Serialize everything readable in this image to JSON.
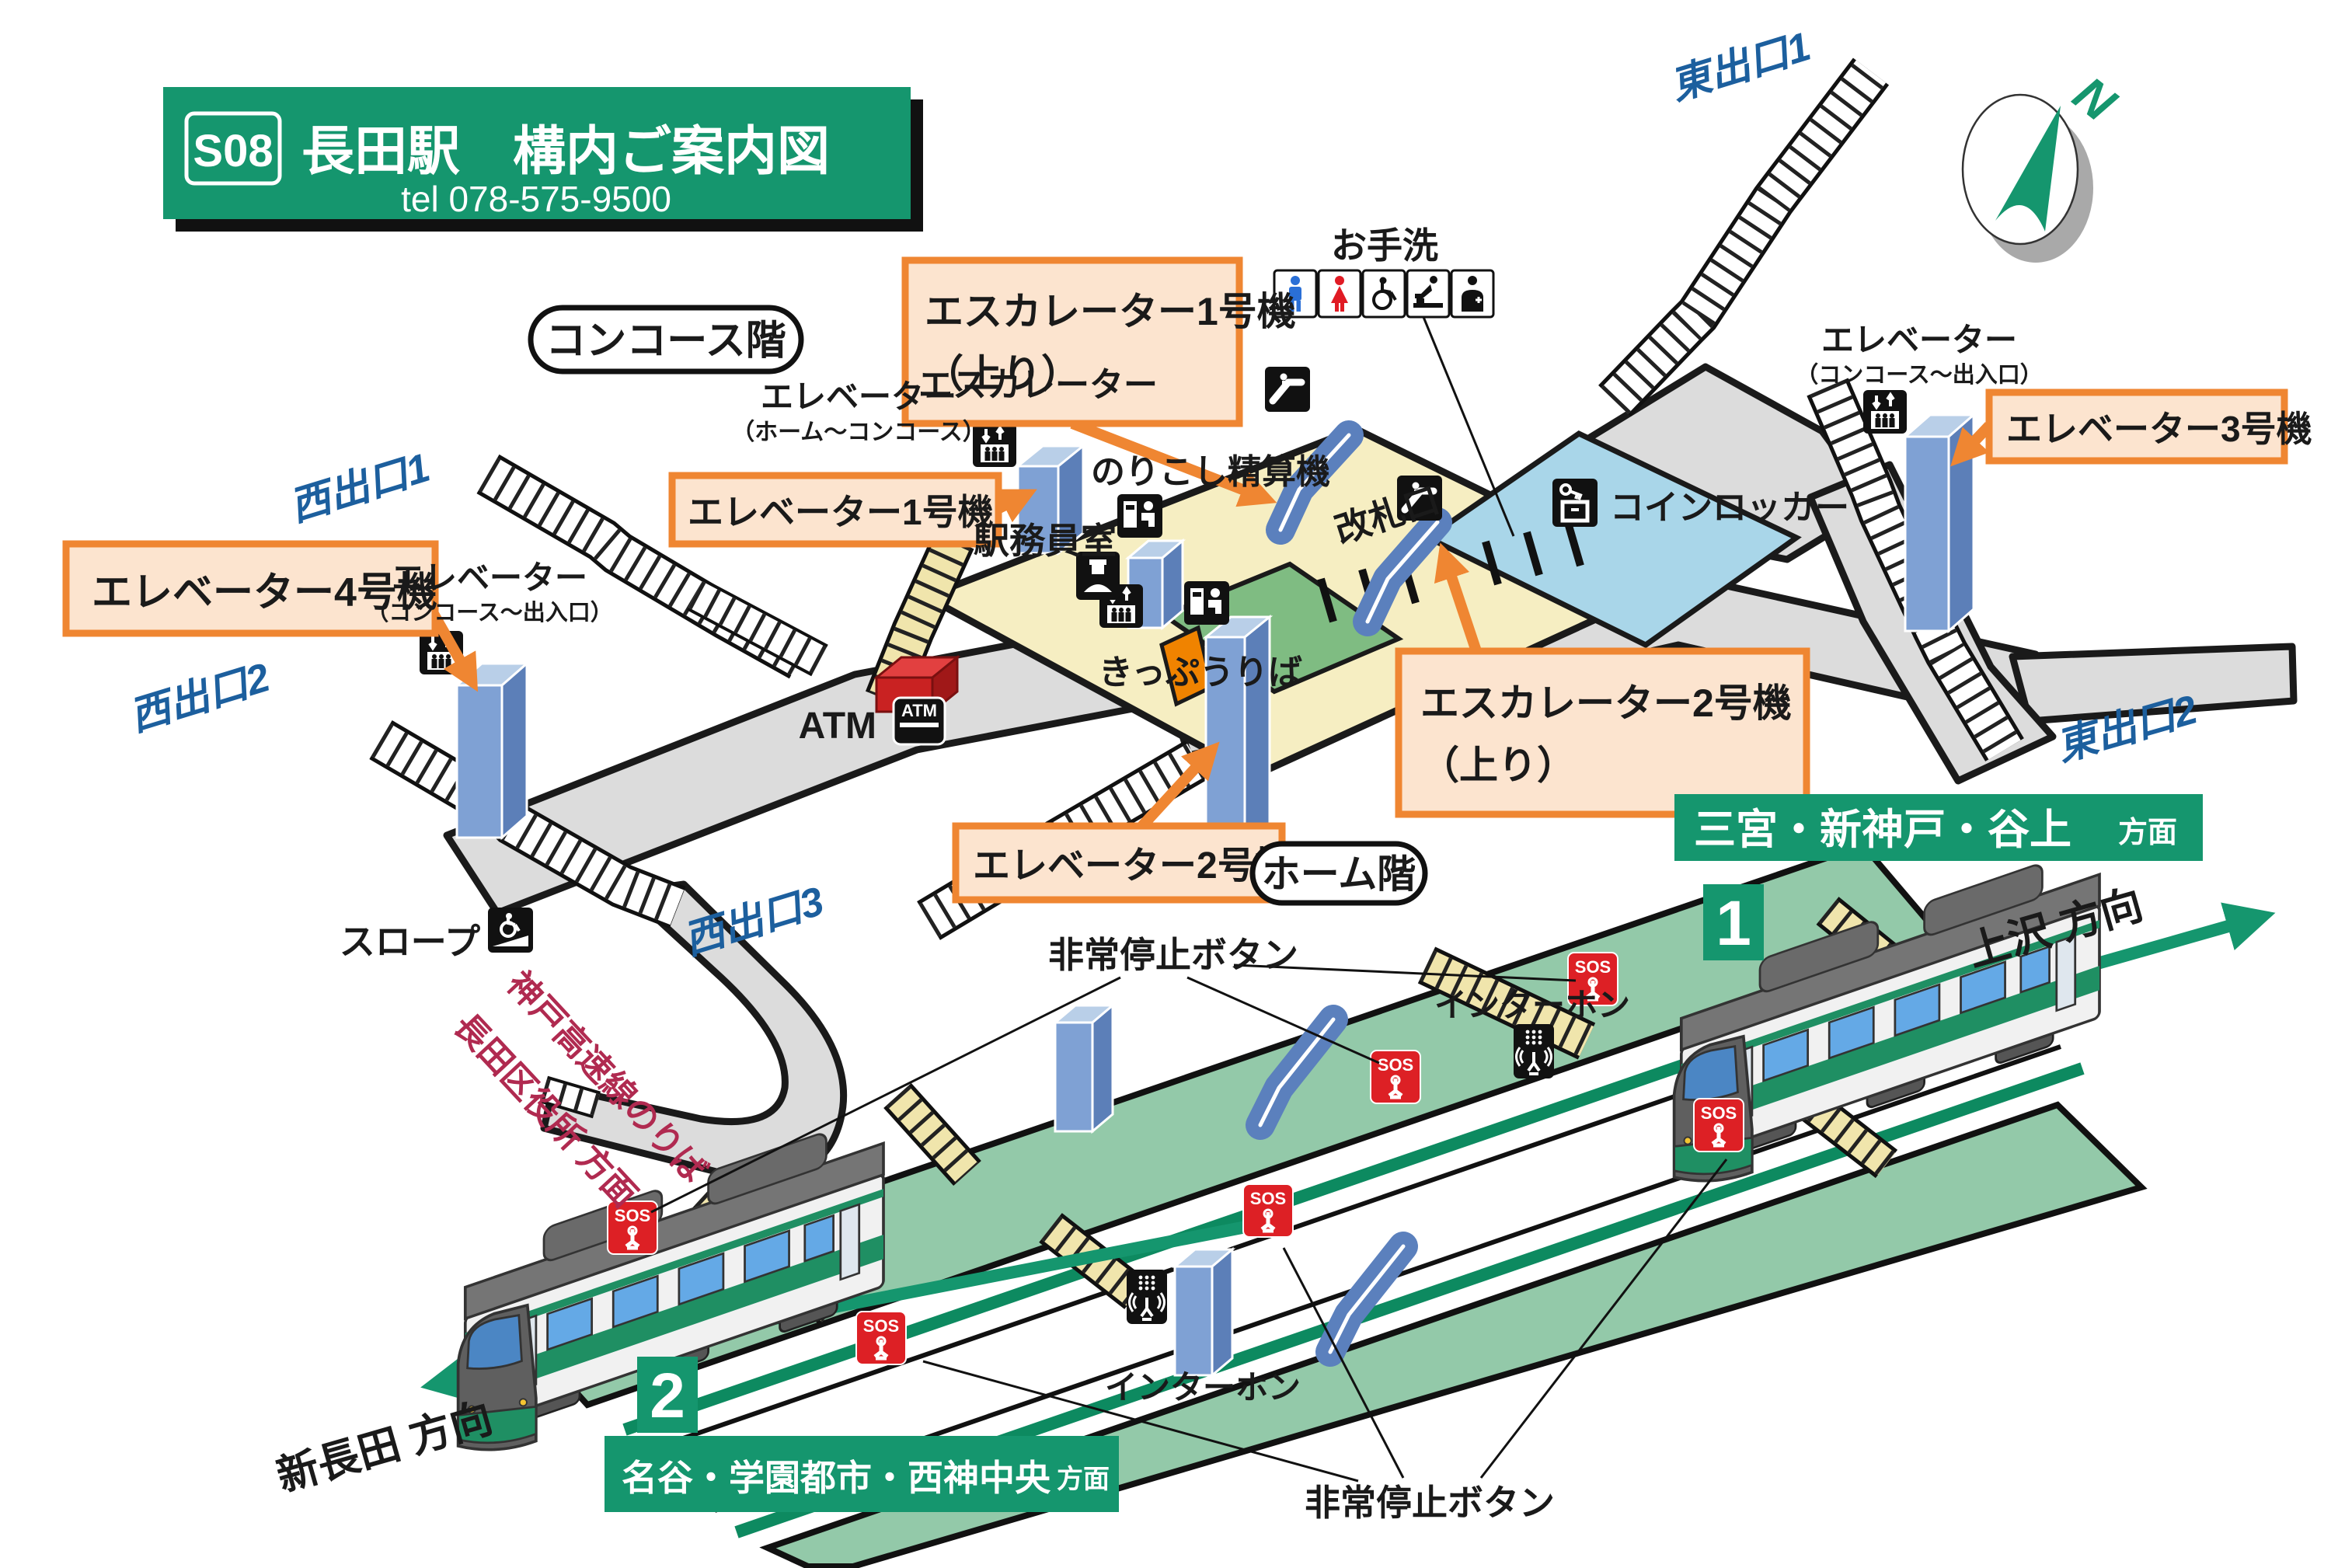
{
  "header": {
    "badge": "S08",
    "title": "長田駅　構内ご案内図",
    "tel": "tel 078-575-9500"
  },
  "floors": {
    "concourse": "コンコース階",
    "platform": "ホーム階"
  },
  "compass": {
    "north": "N"
  },
  "exits": {
    "west1": "西出口1",
    "west2": "西出口2",
    "west3": "西出口3",
    "east1": "東出口1",
    "east2": "東出口2"
  },
  "callouts": {
    "esc1_line1": "エスカレーター1号機",
    "esc1_line2": "（上り）",
    "esc2_line1": "エスカレーター2号機",
    "esc2_line2": "（上り）",
    "ev1": "エレベーター1号機",
    "ev2": "エレベーター2号機",
    "ev3": "エレベーター3号機",
    "ev4": "エレベーター4号機"
  },
  "labels": {
    "escalator": "エスカレーター",
    "elevator": "エレベーター",
    "elevator_range_home": "（ホーム～コンコース）",
    "elevator_range_exit": "（コンコース～出入口）",
    "toilet": "お手洗",
    "fare_adjustment": "のりこし精算機",
    "staff_room": "駅務員室",
    "ticket_gate": "改札口",
    "ticket_office": "きっぷうりば",
    "coin_locker": "コインロッカー",
    "atm": "ATM",
    "atm_icon": "ATM",
    "slope": "スロープ",
    "kobe_line1": "神戸高速線のりば",
    "kobe_line2": "長田区役所 方面"
  },
  "platform": {
    "emergency_stop": "非常停止ボタン",
    "interphone": "インターホン",
    "sos": "SOS",
    "number1": "1",
    "number2": "2",
    "dest1_main": "三宮・新神戸・谷上",
    "dest1_suffix": "方面",
    "dest2_main": "名谷・学園都市・西神中央",
    "dest2_suffix": "方面",
    "dir_kamisawa": "上沢  方向",
    "dir_shinnagata": "新長田  方向"
  },
  "colors": {
    "brand_green": "#15966e",
    "track_green": "#0d8a60",
    "platform_green": "#93c9a9",
    "callout_orange": "#ef8632",
    "callout_fill": "#fce4cf",
    "pillar_blue": "#7fa1d4",
    "escalator_blue": "#5b80bd",
    "paid_cream": "#f6eec2",
    "stair_cream": "#f0e5ac",
    "toilet_blue": "#a9d6e9",
    "staff_green": "#7fbc82",
    "corridor_gray": "#dcdcdc",
    "exit_blue": "#1c5f9e",
    "kobe_red": "#b02a50",
    "sos_red": "#dd2025",
    "gate_orange": "#f08300"
  }
}
